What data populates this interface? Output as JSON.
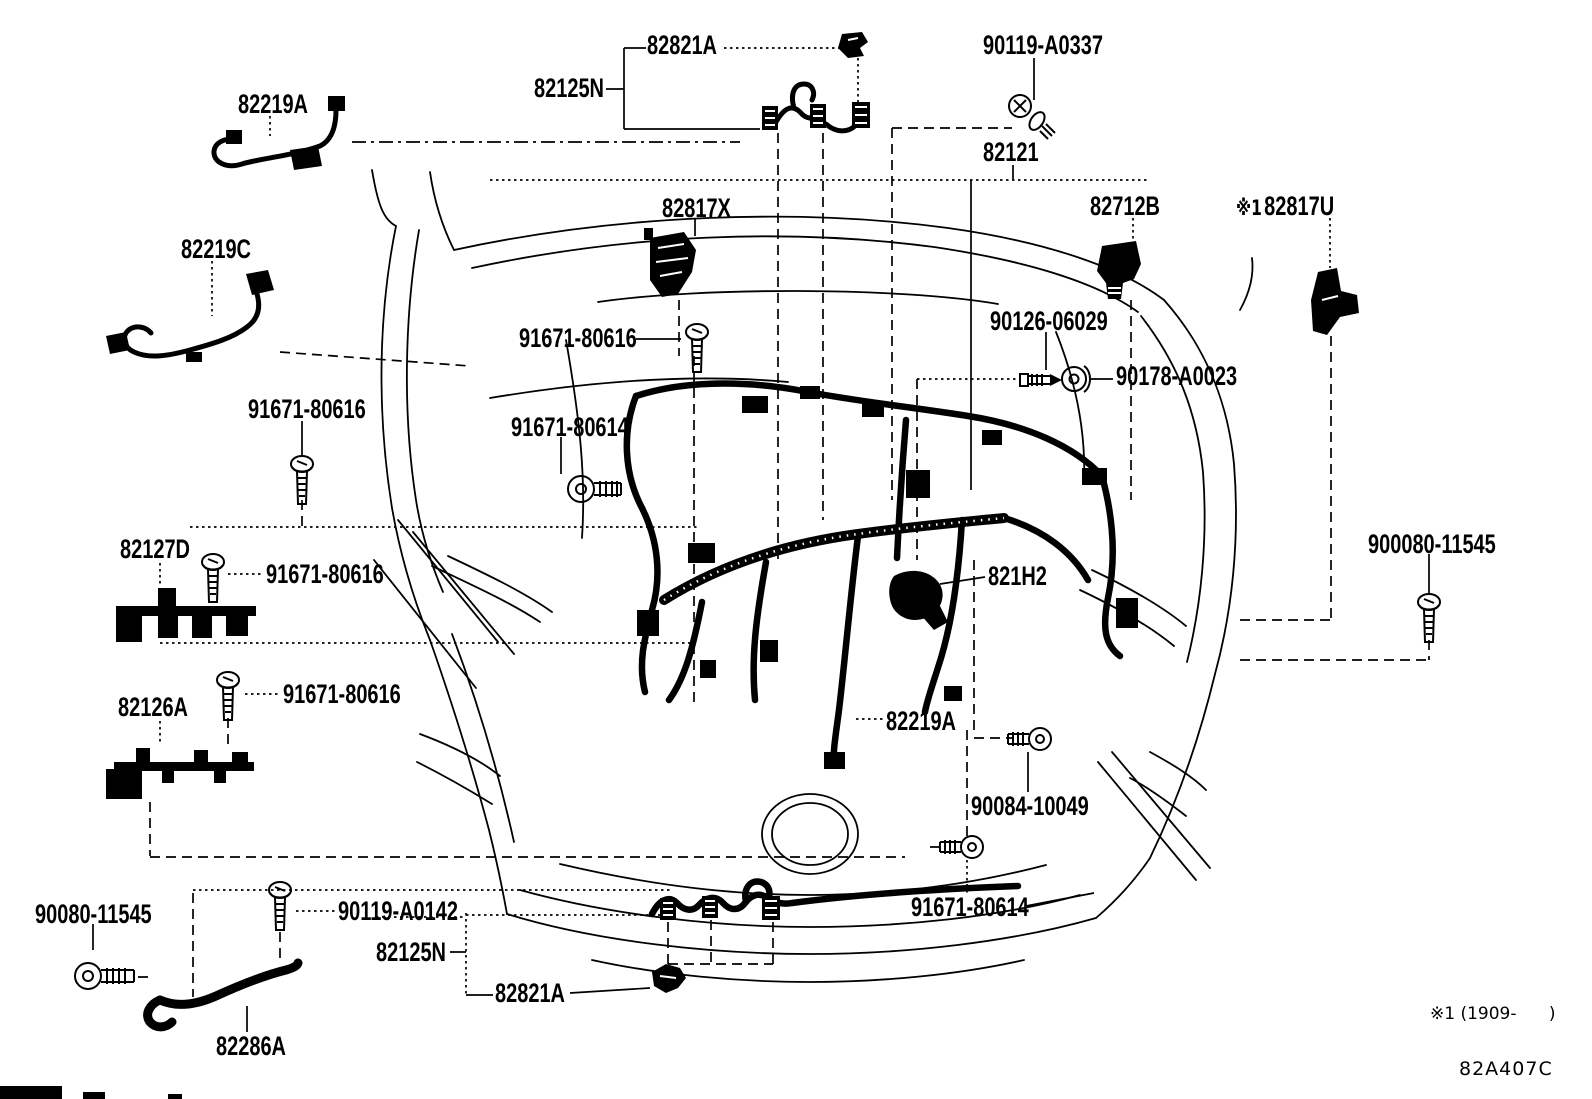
{
  "page": {
    "background": "#ffffff",
    "ink": "#000000"
  },
  "footer": {
    "footnote": "※1 (1909-      )",
    "diagram_code": "82A407C"
  },
  "callouts": {
    "clip_top": {
      "text": "82821A"
    },
    "harness_protector_top": {
      "text": "82125N"
    },
    "bolt_90119_A0337": {
      "text": "90119-A0337"
    },
    "harness_82219A_upper": {
      "text": "82219A"
    },
    "engine_room_main_wire": {
      "text": "82121"
    },
    "connector_82817X": {
      "text": "82817X"
    },
    "holder_82712B": {
      "text": "82712B"
    },
    "bracket_82817U": {
      "prefix": "※1",
      "text": "82817U"
    },
    "harness_82219C": {
      "text": "82219C"
    },
    "bolt_90126_06029": {
      "text": "90126-06029"
    },
    "screw_91671_80616_center": {
      "text": "91671-80616"
    },
    "grommet_90178_A0023": {
      "text": "90178-A0023"
    },
    "bolt_91671_80614_center": {
      "text": "91671-80614"
    },
    "screw_91671_80616_left": {
      "text": "91671-80616"
    },
    "bracket_82127D": {
      "text": "82127D"
    },
    "screw_91671_80616_mid": {
      "text": "91671-80616"
    },
    "screw_900080_11545": {
      "text": "900080-11545"
    },
    "connector_821H2": {
      "text": "821H2"
    },
    "bracket_82126A": {
      "text": "82126A"
    },
    "screw_91671_80616_lower": {
      "text": "91671-80616"
    },
    "harness_82219A_center": {
      "text": "82219A"
    },
    "bolt_90084_10049": {
      "text": "90084-10049"
    },
    "screw_90080_11545": {
      "text": "90080-11545"
    },
    "screw_90119_A0142": {
      "text": "90119-A0142"
    },
    "harness_protector_bottom": {
      "text": "82125N"
    },
    "clip_bottom": {
      "text": "82821A"
    },
    "harness_82286A": {
      "text": "82286A"
    },
    "bolt_91671_80614_bottom": {
      "text": "91671-80614"
    }
  }
}
